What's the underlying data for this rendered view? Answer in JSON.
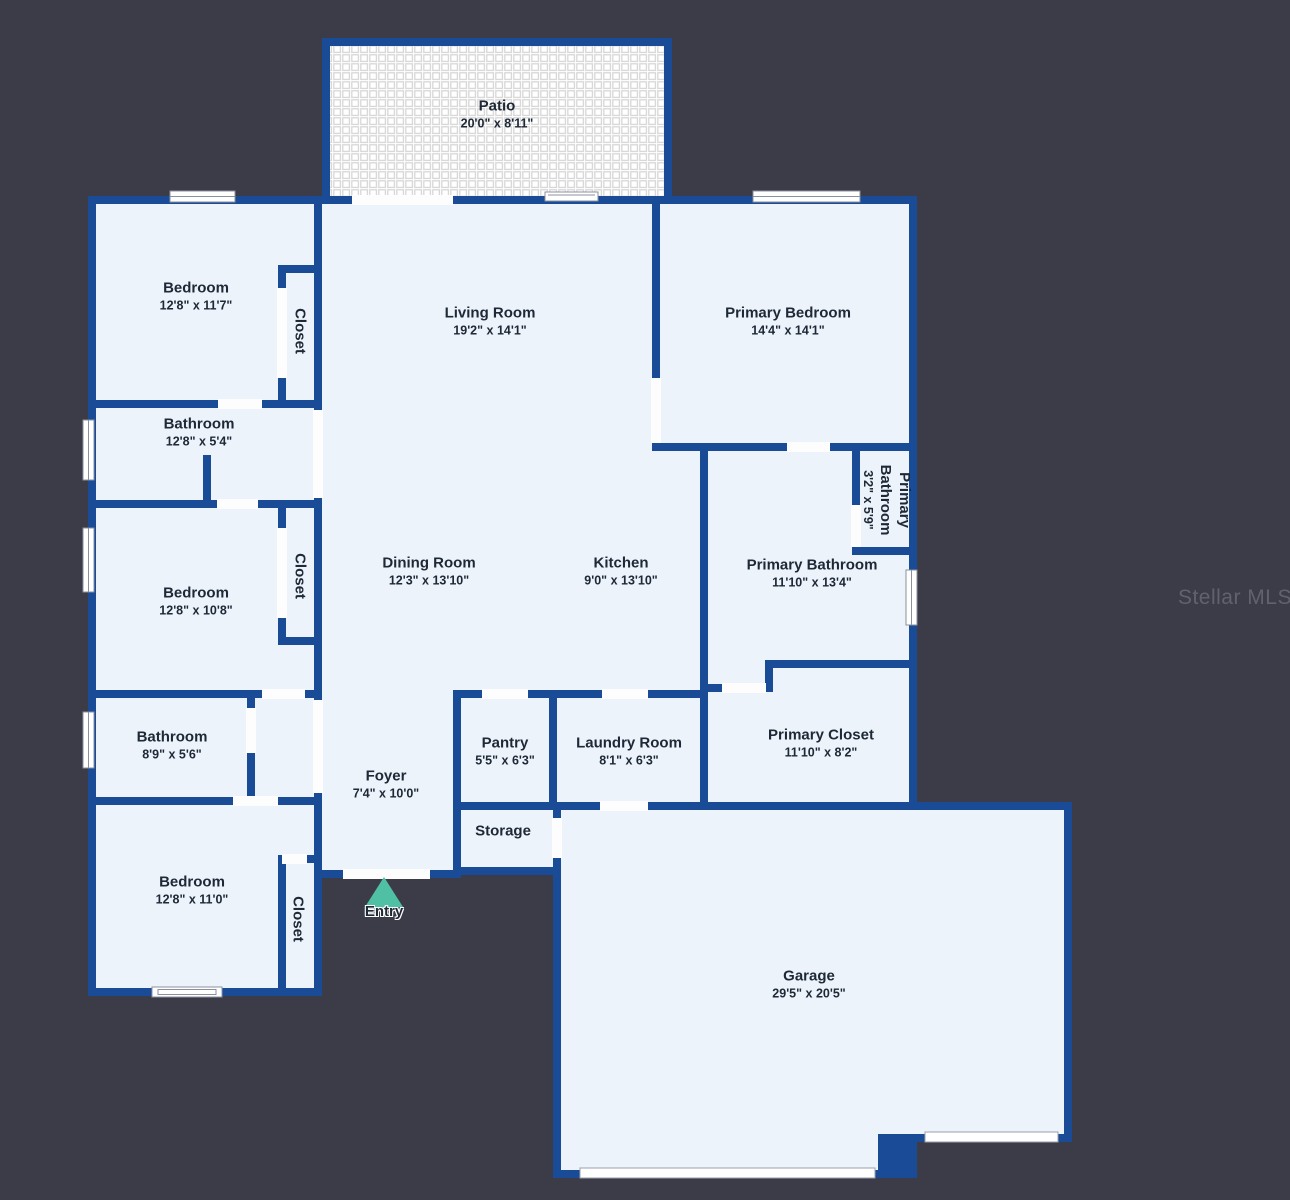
{
  "background_color": "#3c3c48",
  "colors": {
    "wall": "#1a4b96",
    "room_fill": "#ecf3fb",
    "door_gap": "#fdfdfd",
    "label_text": "#1e2836",
    "entry_marker": "#4fc0a4",
    "watermark": "#62626e",
    "patio_tile_grout": "#d8d8d8"
  },
  "watermark": {
    "text": "Stellar MLS"
  },
  "entry": {
    "label": "Entry"
  },
  "floorplan": {
    "rooms": [
      {
        "id": "patio",
        "name": "Patio",
        "dims": "20'0\" x 8'11\"",
        "x": 497,
        "y": 114
      },
      {
        "id": "bedroom-1",
        "name": "Bedroom",
        "dims": "12'8\" x 11'7\"",
        "x": 196,
        "y": 296
      },
      {
        "id": "closet-1",
        "name": "Closet",
        "dims": "",
        "x": 300,
        "y": 331,
        "vertical": true
      },
      {
        "id": "living-room",
        "name": "Living Room",
        "dims": "19'2\" x 14'1\"",
        "x": 490,
        "y": 321
      },
      {
        "id": "primary-bedroom",
        "name": "Primary Bedroom",
        "dims": "14'4\" x 14'1\"",
        "x": 788,
        "y": 321
      },
      {
        "id": "bathroom-1",
        "name": "Bathroom",
        "dims": "12'8\" x 5'4\"",
        "x": 199,
        "y": 432
      },
      {
        "id": "bedroom-2",
        "name": "Bedroom",
        "dims": "12'8\" x 10'8\"",
        "x": 196,
        "y": 601
      },
      {
        "id": "closet-2",
        "name": "Closet",
        "dims": "",
        "x": 300,
        "y": 576,
        "vertical": true
      },
      {
        "id": "dining-room",
        "name": "Dining Room",
        "dims": "12'3\" x 13'10\"",
        "x": 429,
        "y": 571
      },
      {
        "id": "kitchen",
        "name": "Kitchen",
        "dims": "9'0\" x 13'10\"",
        "x": 621,
        "y": 571
      },
      {
        "id": "primary-bathroom-small",
        "name": "Primary Bathroom",
        "dims": "3'2\" x 5'9\"",
        "x": 887,
        "y": 500,
        "vertical": true,
        "wrap": true
      },
      {
        "id": "primary-bathroom",
        "name": "Primary Bathroom",
        "dims": "11'10\" x 13'4\"",
        "x": 812,
        "y": 573
      },
      {
        "id": "bathroom-2",
        "name": "Bathroom",
        "dims": "8'9\" x 5'6\"",
        "x": 172,
        "y": 745
      },
      {
        "id": "pantry",
        "name": "Pantry",
        "dims": "5'5\" x 6'3\"",
        "x": 505,
        "y": 751
      },
      {
        "id": "laundry-room",
        "name": "Laundry Room",
        "dims": "8'1\" x 6'3\"",
        "x": 629,
        "y": 751
      },
      {
        "id": "primary-closet",
        "name": "Primary Closet",
        "dims": "11'10\" x 8'2\"",
        "x": 821,
        "y": 743
      },
      {
        "id": "foyer",
        "name": "Foyer",
        "dims": "7'4\" x 10'0\"",
        "x": 386,
        "y": 784
      },
      {
        "id": "storage",
        "name": "Storage",
        "dims": "",
        "x": 503,
        "y": 831
      },
      {
        "id": "bedroom-3",
        "name": "Bedroom",
        "dims": "12'8\" x 11'0\"",
        "x": 192,
        "y": 890
      },
      {
        "id": "closet-3",
        "name": "Closet",
        "dims": "",
        "x": 298,
        "y": 919,
        "vertical": true
      },
      {
        "id": "garage",
        "name": "Garage",
        "dims": "29'5\" x 20'5\"",
        "x": 809,
        "y": 984
      }
    ]
  }
}
